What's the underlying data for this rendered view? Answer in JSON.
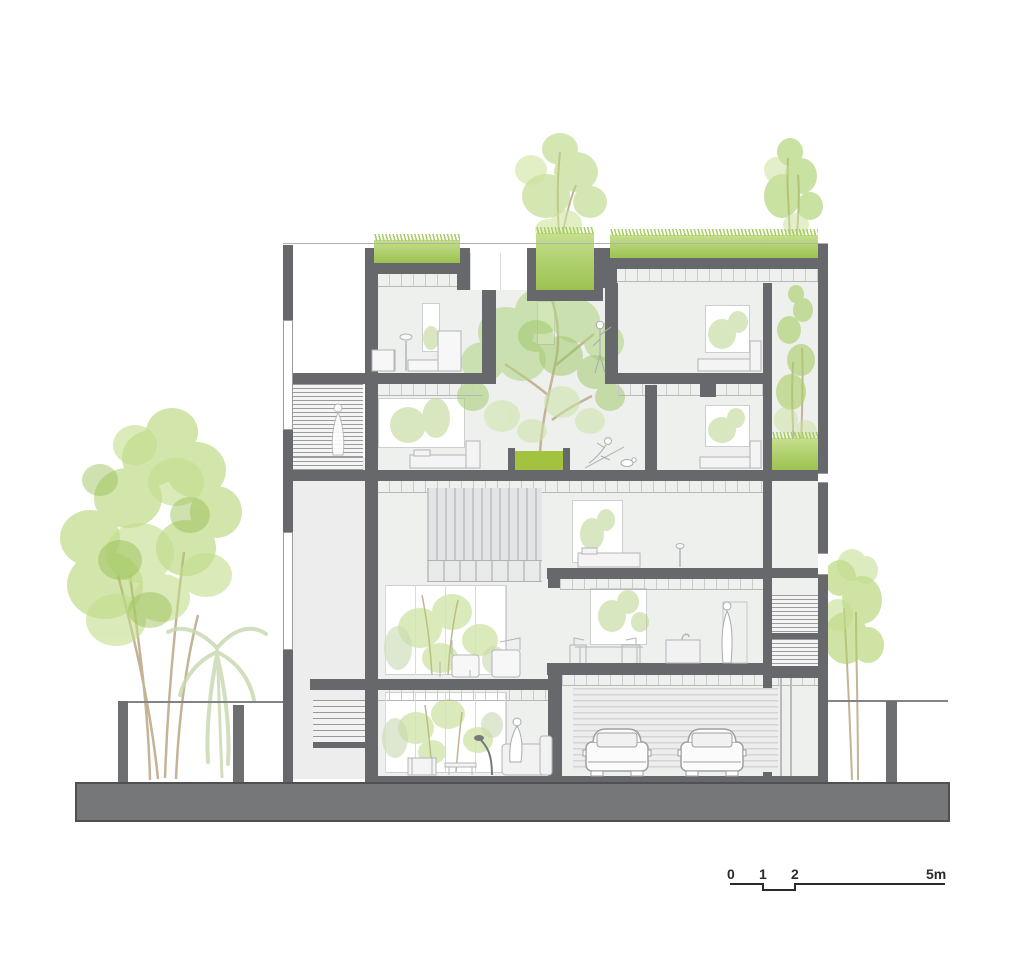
{
  "drawing": {
    "type": "architectural-cross-section",
    "features": {
      "roof_garden": "green roof with grass and trees",
      "atrium_tree": "interior tree in double-height void on green planter",
      "garage_cars": 2,
      "street_trees": "large trees at left, small tree at right"
    }
  },
  "scale_bar": {
    "labels": [
      "0",
      "1",
      "2",
      "5m"
    ],
    "unit": "m"
  },
  "colors": {
    "structure_gray": "#67686b",
    "ground_gray": "#767779",
    "interior_gray": "#edeeee",
    "line_gray": "#c2c3c5",
    "grass_green": "#a7cd60",
    "planter_green": "#a3c23f",
    "foliage_green": "#aed168",
    "pale_foliage": "#c9dab3",
    "trunk_brown": "#c4b395",
    "scale_text": "#2a2a2a"
  }
}
